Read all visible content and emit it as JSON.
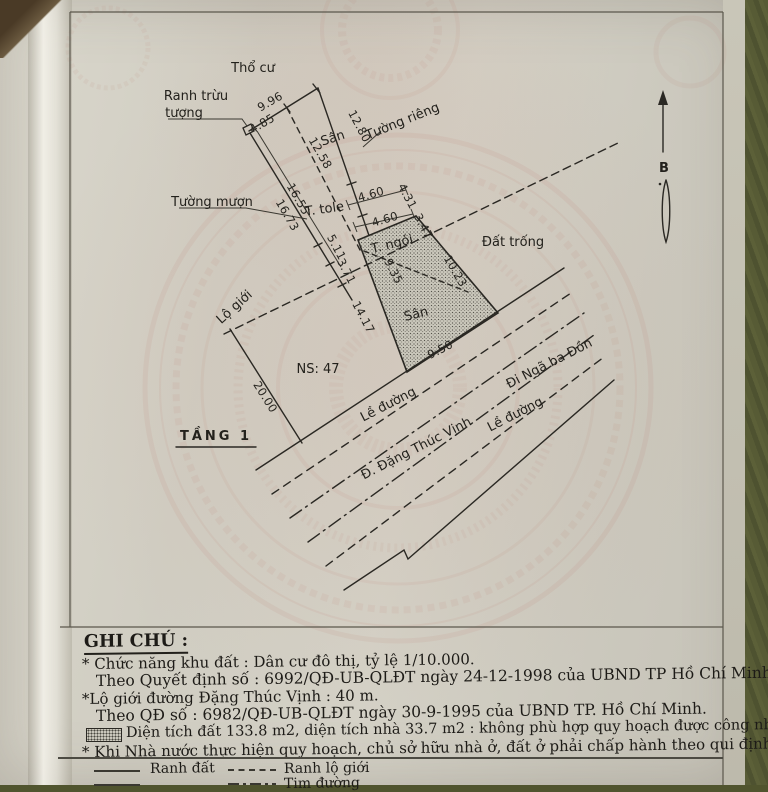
{
  "drawing": {
    "title": "TẦNG 1",
    "north_label": "B",
    "labels": {
      "tho_cu": "Thổ cư",
      "ranh_truu_1": "Ranh trừu",
      "ranh_truu_2": "tượng",
      "tuong_rieng": "Tường riêng",
      "tuong_muon": "Tường mượn",
      "san_upper": "Sân",
      "t_tole": "T. tole",
      "t_ngoi": "T. ngói",
      "san_lower": "Sân",
      "dat_trong": "Đất trống",
      "lo_gioi": "Lộ giới",
      "ns": "NS: 47",
      "le_duong_1": "Lề đường",
      "street": "Đ. Đặng Thúc Vịnh",
      "le_duong_2": "Lề đường",
      "di_nga_ba_don": "Đi Ngã ba Đồn"
    },
    "dims": {
      "d996": "9.96",
      "d485": "4.85",
      "d1280": "12.80",
      "d1258": "12.58",
      "d1655": "16.55",
      "d1673": "16.73",
      "d460a": "4.60",
      "d460b": "4.60",
      "d431": "4.31",
      "d347": "3.47",
      "d511": "5.11",
      "d371": "3.71",
      "d935": "9.35",
      "d1023": "10.23",
      "d1417": "14.17",
      "d950": "9.50",
      "d2000": "20.00"
    }
  },
  "notes": {
    "heading": "GHI CHÚ :",
    "lines": [
      "* Chức năng khu đất : Dân cư đô thị, tỷ lệ 1/10.000.",
      "Theo Quyết định số : 6992/QĐ-UB-QLĐT ngày 24-12-1998 của UBND TP Hồ Chí Minh.",
      "*Lộ giới đường Đặng Thúc Vịnh : 40 m.",
      "Theo QĐ số : 6982/QĐ-UB-QLĐT ngày 30-9-1995 của UBND TP. Hồ Chí Minh.",
      "Diện tích đất 133.8 m2, diện tích nhà 33.7 m2 : không phù hợp quy hoạch được công nhận.",
      "* Khi Nhà nước thực hiện quy hoạch, chủ sở hữu nhà ở, đất ở phải chấp hành theo qui định."
    ]
  },
  "legend": {
    "ranh_dat": "Ranh đất",
    "ranh_lo_gioi": "Ranh lộ giới",
    "tim_duong": "Tim đường"
  },
  "colors": {
    "paper": "#d2cfc4",
    "ink": "#2a2823",
    "table_background": "#575b35",
    "watermark": "#bd6c60"
  }
}
